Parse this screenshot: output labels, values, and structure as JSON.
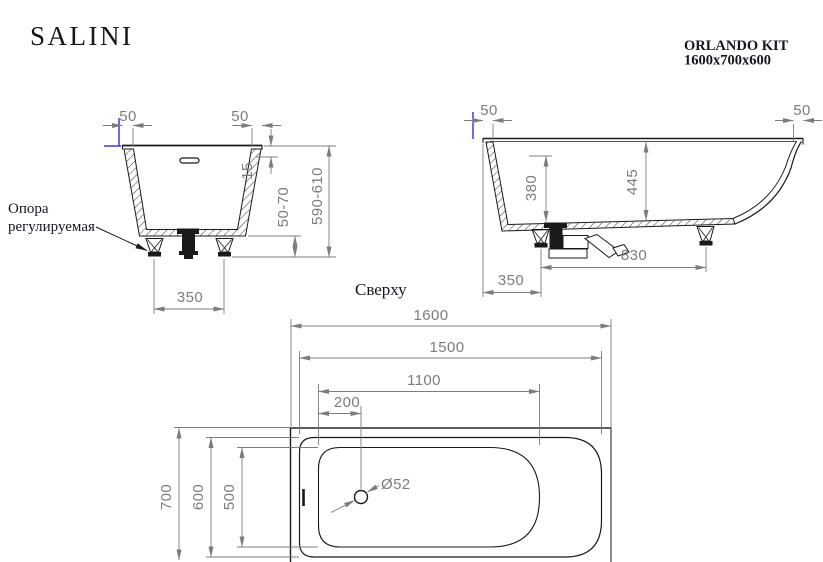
{
  "colors": {
    "line": "#1a1a1a",
    "dimension": "#7c7c7c",
    "highlight": "#3a3ae0",
    "background": "#ffffff"
  },
  "header": {
    "brand": "SALINI",
    "model": "ORLANDO KIT",
    "size": "1600x700x600"
  },
  "front_view": {
    "support_label_line1": "Опора",
    "support_label_line2": "регулируемая",
    "dims": {
      "rim_overhang_left": "50",
      "rim_overhang_right": "50",
      "rim_edge_height": "15",
      "foot_height_range": "50-70",
      "overall_height_range": "590-610",
      "feet_spacing": "350"
    }
  },
  "side_view": {
    "dims": {
      "rim_overhang_left": "50",
      "rim_overhang_right": "50",
      "depth_to_bottom": "380",
      "overall_depth": "445",
      "feet_spacing": "830",
      "drain_to_edge": "350"
    }
  },
  "top_view": {
    "label": "Сверху",
    "dims": {
      "overall_length": "1600",
      "rim_length": "1500",
      "bottom_length": "1100",
      "drain_offset": "200",
      "overall_width": "700",
      "rim_width": "600",
      "bottom_width": "500",
      "drain_diameter": "Ø52"
    }
  }
}
